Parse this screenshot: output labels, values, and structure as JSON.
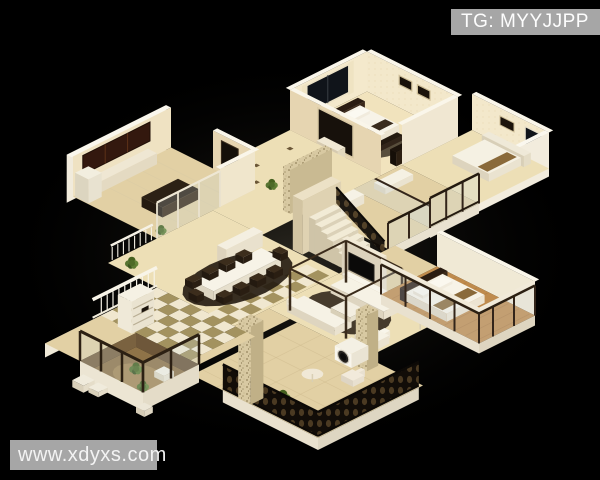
{
  "watermarks": {
    "top_right": {
      "label": "TG: MYYJJPP",
      "bg": "#a6a6a6",
      "color": "#fdfdfd"
    },
    "bottom_left": {
      "label": "www.xdyxs.com",
      "bg": "#a6a6a6",
      "color": "#f3f3f3"
    }
  },
  "scene": {
    "type": "isometric-3d-floorplan-model",
    "background": "#000000",
    "rooms": [
      "kitchen",
      "entry-hall",
      "master-bedroom",
      "second-bedroom",
      "glass-balcony",
      "bathroom",
      "staircase",
      "dining-room",
      "living-room",
      "garden-bedroom",
      "terrace",
      "tiled-balcony",
      "sunken-garden"
    ],
    "palette": {
      "floor": "#eddfb6",
      "floor_mid": "#e2d0a4",
      "wall": "#f4ead0",
      "wall_shade": "#e6d5b1",
      "white_trim": "#f5f1e4",
      "wood_floor": "#bf8b4d",
      "dark_wood": "#33251a",
      "window": "#10141a",
      "iron_railing": "#120d08",
      "glass": "#cfdde4",
      "plant": "#5d7c33",
      "rug": "#241c12",
      "stone": "#d8c9a2",
      "checker_light": "#f0e7cf",
      "checker_dark": "#a3925f",
      "cabinet": "#33180e"
    }
  }
}
